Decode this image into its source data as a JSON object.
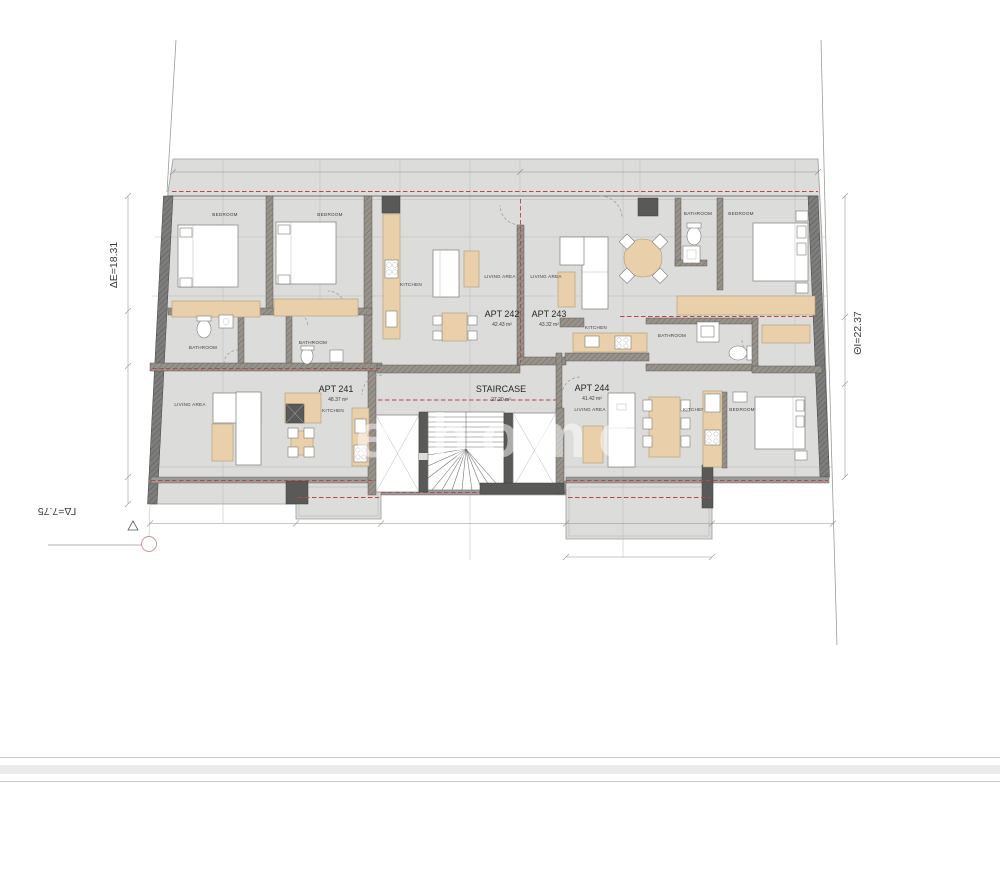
{
  "plan": {
    "apartments": [
      {
        "name": "APT 241",
        "area": "48.37 m²"
      },
      {
        "name": "APT 242",
        "area": "42.43 m²"
      },
      {
        "name": "APT 243",
        "area": "43.32 m²"
      },
      {
        "name": "APT 244",
        "area": "41.42 m²"
      }
    ],
    "staircase": {
      "name": "STAIRCASE",
      "area": "27.20 m²"
    },
    "rooms": {
      "bedroom": "BEDROOM",
      "bathroom": "BATHROOM",
      "kitchen": "KITCHEN",
      "living_area": "LIVING AREA"
    }
  },
  "site": {
    "left_boundary": "ΔΕ=18.31",
    "right_boundary": "ΘΙ=22.37",
    "bottom_boundary": "ΓΔ=7.75"
  },
  "watermark": "e home",
  "colors": {
    "floor": "#dcdcda",
    "wall_dark": "#595957",
    "furniture_beige": "#e9d0ab",
    "red_dash": "#c14343"
  }
}
